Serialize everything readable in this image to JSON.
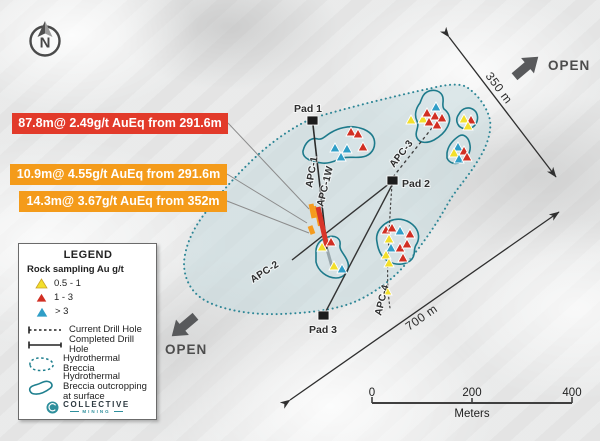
{
  "compass": {
    "label": "N"
  },
  "callouts": [
    {
      "text": "87.8m@ 2.49g/t AuEq from 291.6m",
      "color": "#e23a2a"
    },
    {
      "text": "10.9m@ 4.55g/t AuEq from 291.6m",
      "color": "#f49b1a"
    },
    {
      "text": "14.3m@ 3.67g/t AuEq from 352m",
      "color": "#f49b1a"
    }
  ],
  "pads": [
    {
      "label": "Pad 1"
    },
    {
      "label": "Pad 2"
    },
    {
      "label": "Pad 3"
    }
  ],
  "drill_holes": [
    {
      "label": "APC-1"
    },
    {
      "label": "APC-1W"
    },
    {
      "label": "APC-2"
    },
    {
      "label": "APC-3"
    },
    {
      "label": "APC-4"
    }
  ],
  "open_markers": [
    {
      "label": "OPEN",
      "direction": "northeast"
    },
    {
      "label": "OPEN",
      "direction": "southwest"
    }
  ],
  "measurements": [
    {
      "label": "350 m"
    },
    {
      "label": "700 m"
    }
  ],
  "scale_bar": {
    "ticks": [
      "0",
      "200",
      "400"
    ],
    "unit_label": "Meters"
  },
  "legend": {
    "title": "LEGEND",
    "sampling_title": "Rock sampling Au g/t",
    "classes": [
      {
        "label": "0.5 - 1",
        "color_key": "yellow"
      },
      {
        "label": "1 - 3",
        "color_key": "red"
      },
      {
        "label": "> 3",
        "color_key": "blue"
      }
    ],
    "lines": [
      {
        "label": "Current Drill Hole",
        "style": "dashed"
      },
      {
        "label": "Completed Drill Hole",
        "style": "solid"
      }
    ],
    "areas": [
      {
        "label": "Hydrothermal Breccia",
        "style": "dashed"
      },
      {
        "label": "Hydrothermal Breccia outcropping at surface",
        "style": "solid"
      }
    ],
    "logo": {
      "name": "COLLECTIVE",
      "subtitle": "MINING"
    }
  },
  "colors": {
    "yellow": "#f3df2b",
    "red": "#d12f23",
    "blue": "#2f9ec7",
    "teal": "#20808f",
    "callout_red": "#e23a2a",
    "callout_orange": "#f49b1a",
    "trace_orange": "#f59b1e",
    "trace_red": "#d8352a"
  },
  "markers": [
    {
      "c": "red",
      "x": 351,
      "y": 132
    },
    {
      "c": "red",
      "x": 358,
      "y": 134
    },
    {
      "c": "blue",
      "x": 335,
      "y": 148
    },
    {
      "c": "blue",
      "x": 347,
      "y": 149
    },
    {
      "c": "red",
      "x": 363,
      "y": 147
    },
    {
      "c": "blue",
      "x": 341,
      "y": 157
    },
    {
      "c": "yellow",
      "x": 411,
      "y": 120
    },
    {
      "c": "blue",
      "x": 436,
      "y": 107
    },
    {
      "c": "yellow",
      "x": 423,
      "y": 119
    },
    {
      "c": "red",
      "x": 427,
      "y": 113
    },
    {
      "c": "red",
      "x": 435,
      "y": 116
    },
    {
      "c": "red",
      "x": 442,
      "y": 118
    },
    {
      "c": "red",
      "x": 429,
      "y": 122
    },
    {
      "c": "red",
      "x": 437,
      "y": 125
    },
    {
      "c": "yellow",
      "x": 464,
      "y": 119
    },
    {
      "c": "red",
      "x": 471,
      "y": 120
    },
    {
      "c": "yellow",
      "x": 468,
      "y": 126
    },
    {
      "c": "blue",
      "x": 458,
      "y": 147
    },
    {
      "c": "red",
      "x": 464,
      "y": 151
    },
    {
      "c": "yellow",
      "x": 454,
      "y": 153
    },
    {
      "c": "blue",
      "x": 459,
      "y": 159
    },
    {
      "c": "red",
      "x": 467,
      "y": 157
    },
    {
      "c": "yellow",
      "x": 322,
      "y": 247
    },
    {
      "c": "red",
      "x": 331,
      "y": 242
    },
    {
      "c": "yellow",
      "x": 334,
      "y": 266
    },
    {
      "c": "blue",
      "x": 342,
      "y": 269
    },
    {
      "c": "red",
      "x": 386,
      "y": 230
    },
    {
      "c": "red",
      "x": 392,
      "y": 228
    },
    {
      "c": "blue",
      "x": 400,
      "y": 231
    },
    {
      "c": "red",
      "x": 410,
      "y": 234
    },
    {
      "c": "yellow",
      "x": 389,
      "y": 239
    },
    {
      "c": "blue",
      "x": 391,
      "y": 248
    },
    {
      "c": "red",
      "x": 400,
      "y": 248
    },
    {
      "c": "red",
      "x": 407,
      "y": 244
    },
    {
      "c": "yellow",
      "x": 386,
      "y": 255
    },
    {
      "c": "red",
      "x": 403,
      "y": 258
    },
    {
      "c": "yellow",
      "x": 389,
      "y": 263
    },
    {
      "c": "yellow",
      "x": 387,
      "y": 291
    }
  ]
}
